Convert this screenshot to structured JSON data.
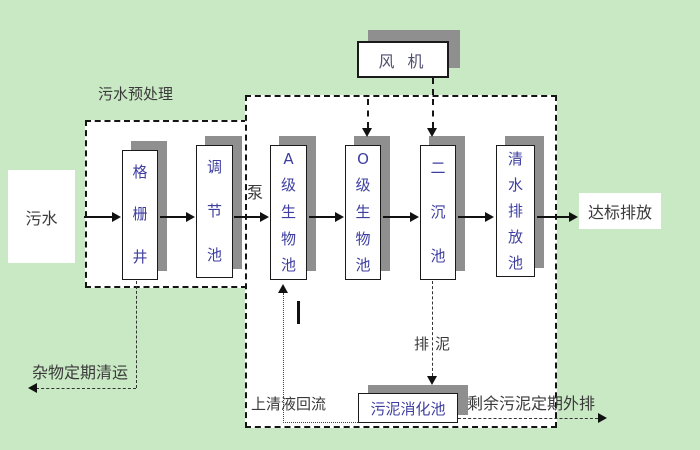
{
  "colors": {
    "background": "#c9e9c4",
    "box_shadow": "#8f8f8f",
    "tank_text": "#3e3ea0",
    "annotation_text": "#3a3a3a"
  },
  "labels": {
    "influent": "污水",
    "pretreatment_title": "污水预处理",
    "pump": "泵",
    "discharge": "达标排放",
    "debris_removal": "杂物定期清运",
    "supernatant_return": "上清液回流",
    "sludge_drain": "排泥",
    "excess_sludge": "剩余污泥定期外排"
  },
  "boxes": {
    "grid_well": "格栅井",
    "regulating_tank": "调节池",
    "tank_a": "A级生物池",
    "tank_o": "O级生物池",
    "secondary_tank": "二沉池",
    "clearwater_tank": "清水排放池",
    "blower": "风 机",
    "digester": "污泥消化池"
  }
}
